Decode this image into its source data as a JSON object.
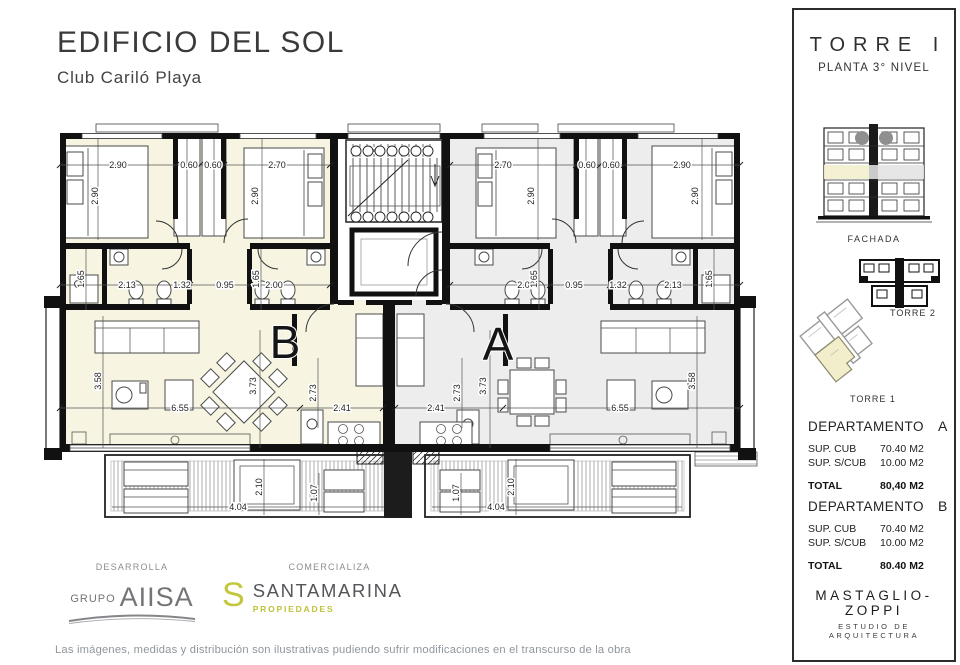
{
  "page": {
    "title": "EDIFICIO DEL SOL",
    "subtitle": "Club Cariló Playa",
    "disclaimer": "Las imágenes, medidas y distribución son ilustrativas pudiendo sufrir modificaciones en el transcurso de la obra"
  },
  "sidebar": {
    "tower_title": "TORRE I",
    "tower_subtitle": "PLANTA 3° NIVEL",
    "fachada_label": "FACHADA",
    "torre2_label": "TORRE 2",
    "torre1_label": "TORRE 1",
    "dept_a": {
      "name": "DEPARTAMENTO",
      "unit": "A",
      "rows": [
        {
          "label": "SUP. CUB",
          "value": "70.40 M2"
        },
        {
          "label": "SUP. S/CUB",
          "value": "10.00 M2"
        }
      ],
      "total_label": "TOTAL",
      "total_value": "80,40 M2"
    },
    "dept_b": {
      "name": "DEPARTAMENTO",
      "unit": "B",
      "rows": [
        {
          "label": "SUP. CUB",
          "value": "70.40 M2"
        },
        {
          "label": "SUP. S/CUB",
          "value": "10.00 M2"
        }
      ],
      "total_label": "TOTAL",
      "total_value": "80.40 M2"
    },
    "studio_name": "MASTAGLIO-ZOPPI",
    "studio_sub": "ESTUDIO DE ARQUITECTURA"
  },
  "footer": {
    "desarrolla_label": "DESARROLLA",
    "grupo_prefix": "GRUPO",
    "grupo_name": "AIISA",
    "comercializa_label": "COMERCIALIZA",
    "santamarina_s": "S",
    "santamarina_name": "SANTAMARINA",
    "santamarina_sub": "PROPIEDADES"
  },
  "plan": {
    "unit_b_label": "B",
    "unit_a_label": "A",
    "dims": {
      "b_bed1_w": "2.90",
      "b_bed1_h": "2.90",
      "b_cl1": "0.60",
      "b_cl2": "0.60",
      "b_bed2_w": "2.70",
      "b_bed2_h": "2.90",
      "a_bed2_w": "2.70",
      "a_bed2_h": "2.90",
      "a_cl1": "0.60",
      "a_cl2": "0.60",
      "a_bed1_w": "2.90",
      "a_bed1_h": "2.90",
      "b_bath_w1": "2.13",
      "b_bath_w2": "1.32",
      "b_bath_w3": "0.95",
      "b_bath_w4": "2.00",
      "b_bath_h1": "1.65",
      "b_bath_h2": "1.65",
      "a_bath_w1": "2.00",
      "a_bath_w2": "0.95",
      "a_bath_w3": "1.32",
      "a_bath_w4": "2.13",
      "a_bath_h1": "1.65",
      "a_bath_h2": "1.65",
      "b_living_w": "6.55",
      "b_living_h": "3.58",
      "b_dining_h": "3.73",
      "b_kitchen_w": "2.41",
      "b_kitchen_h": "2.73",
      "a_living_w": "6.55",
      "a_living_h": "3.58",
      "a_dining_h": "3.73",
      "a_kitchen_w": "2.41",
      "a_kitchen_h": "2.73",
      "b_balc_depth": "2.10",
      "b_balc_min": "1.07",
      "b_balc_w": "4.04",
      "a_balc_depth": "2.10",
      "a_balc_min": "1.07",
      "a_balc_w": "4.04"
    }
  },
  "colors": {
    "apartment_b_fill": "#f7f5e2",
    "apartment_a_fill": "#ededee",
    "wall": "#111111",
    "brand_green": "#c3c73e",
    "logo_gray": "#747578"
  }
}
